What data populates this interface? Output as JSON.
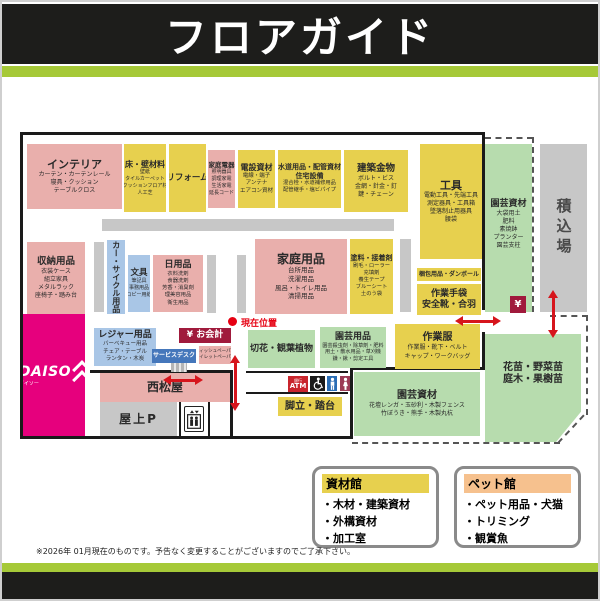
{
  "header": {
    "title": "フロアガイド"
  },
  "map": {
    "markers": {
      "current_location": "現在位置"
    },
    "areas": {
      "interior": {
        "title": "インテリア",
        "lines": [
          "カーテン・カーテンレール",
          "寝具・クッション",
          "テーブルクロス"
        ]
      },
      "floor_wall": {
        "title": "床・壁材料",
        "lines": [
          "壁紙",
          "タイルカーペット",
          "クッションフロア材",
          "人工芝"
        ]
      },
      "reform": {
        "title": "リフォーム"
      },
      "home_appliance": {
        "title": "家庭電器",
        "lines": [
          "照明器具",
          "調理家電",
          "生活家電",
          "延長コード"
        ]
      },
      "electric": {
        "title": "電設資材",
        "lines": [
          "電線・端子",
          "アンテナ",
          "エアコン資材"
        ]
      },
      "plumbing": {
        "title": "水道用品・配管資材",
        "title2": "住宅設備",
        "lines": [
          "混合栓・水道補修用品",
          "配管継手・塩ビパイプ"
        ]
      },
      "hardware": {
        "title": "建築金物",
        "lines": [
          "ボルト・ビス",
          "金網・針金・釘",
          "鍵・チェーン"
        ]
      },
      "tools": {
        "title": "工具",
        "lines": [
          "電動工具・先端工具",
          "測定器具・工具箱",
          "墜落制止用器具",
          "腰袋"
        ]
      },
      "garden_supply_right": {
        "title": "園芸資材",
        "lines": [
          "大袋用土",
          "肥料",
          "素焼鉢",
          "プランター",
          "園芸支柱"
        ]
      },
      "loading": {
        "title": "積込場"
      },
      "storage": {
        "title": "収納用品",
        "lines": [
          "衣装ケース",
          "組立家具",
          "メタルラック",
          "座椅子・踏み台"
        ]
      },
      "car_cycle": {
        "title": "カー・サイクル用品"
      },
      "stationery": {
        "title": "文具",
        "lines": [
          "筆記具",
          "事務用品",
          "コピー用紙"
        ]
      },
      "daily": {
        "title": "日用品",
        "lines": [
          "衣料洗剤",
          "食器洗剤",
          "芳香・消臭剤",
          "理美容用品",
          "衛生用品"
        ]
      },
      "household": {
        "title": "家庭用品",
        "lines": [
          "台所用品",
          "洗濯用品",
          "風呂・トイレ用品",
          "清掃用品"
        ]
      },
      "paint": {
        "title": "塗料・接着剤",
        "lines": [
          "刷毛・ローラー",
          "充填剤",
          "養生テープ",
          "ブルーシート",
          "土のう袋"
        ]
      },
      "packing": {
        "title": "梱包用品・ダンボール"
      },
      "work_gloves": {
        "title": "作業手袋",
        "title2": "安全靴・合羽"
      },
      "yen_box": {
        "title": "¥"
      },
      "workwear": {
        "title": "作業服",
        "lines": [
          "作業服・靴下・ベルト",
          "キャップ・ワークバッグ"
        ]
      },
      "cut_flowers": {
        "title": "切花・観葉植物"
      },
      "garden_goods": {
        "title": "園芸用品",
        "lines": [
          "園芸殺虫剤・除草剤・肥料",
          "用土・散水用品・草刈機",
          "鎌・鍬・剪定工具"
        ]
      },
      "leisure": {
        "title": "レジャー用品",
        "lines": [
          "バーベキュー用品",
          "チェア・テーブル",
          "ランタン・木炭"
        ]
      },
      "checkout": {
        "title": "¥ お会計"
      },
      "service_desk": {
        "title": "サービスデスク"
      },
      "tissue": {
        "lines": [
          "ティッシュペーパー",
          "トイレットペーパー"
        ]
      },
      "daiso": {
        "title": "DAISO",
        "sub": "ダイソー"
      },
      "nishimatsuya": {
        "title": "西松屋"
      },
      "roof_parking": {
        "title": "屋上P"
      },
      "atm": {
        "bank": "銀行",
        "title": "ATM"
      },
      "stepladder": {
        "title": "脚立・踏台"
      },
      "garden_material_bottom": {
        "title": "園芸資材",
        "lines": [
          "花壇レンガ・玉砂利・木製フェンス",
          "竹ぼうき・熊手・木製丸杭"
        ]
      },
      "outdoor_plants": {
        "lines": [
          "花苗・野菜苗",
          "庭木・果樹苗"
        ]
      }
    },
    "colors": {
      "pink": "#e9afac",
      "yellow": "#e7d04e",
      "blue": "#a9c6e6",
      "green": "#b7dcae",
      "gray": "#c7c7c7",
      "magenta": "#e6007d",
      "dark_red": "#a01a3c",
      "atm_red": "#c9252c",
      "arrow_red": "#d6151c",
      "current_red": "#e60012",
      "header_green": "#a6c938",
      "service_blue": "#4577bb",
      "man_blue": "#2a6db5",
      "woman_red": "#9c3a55"
    }
  },
  "legend": {
    "shizai": {
      "title": "資材館",
      "items": [
        "・木材・建築資材",
        "・外構資材",
        "・加工室"
      ]
    },
    "pet": {
      "title": "ペット館",
      "items": [
        "・ペット用品・犬猫",
        "・トリミング",
        "・観賞魚"
      ]
    }
  },
  "footer": {
    "note": "※2026年 01月現在のものです。予告なく変更することがございますのでご了承下さい。"
  }
}
